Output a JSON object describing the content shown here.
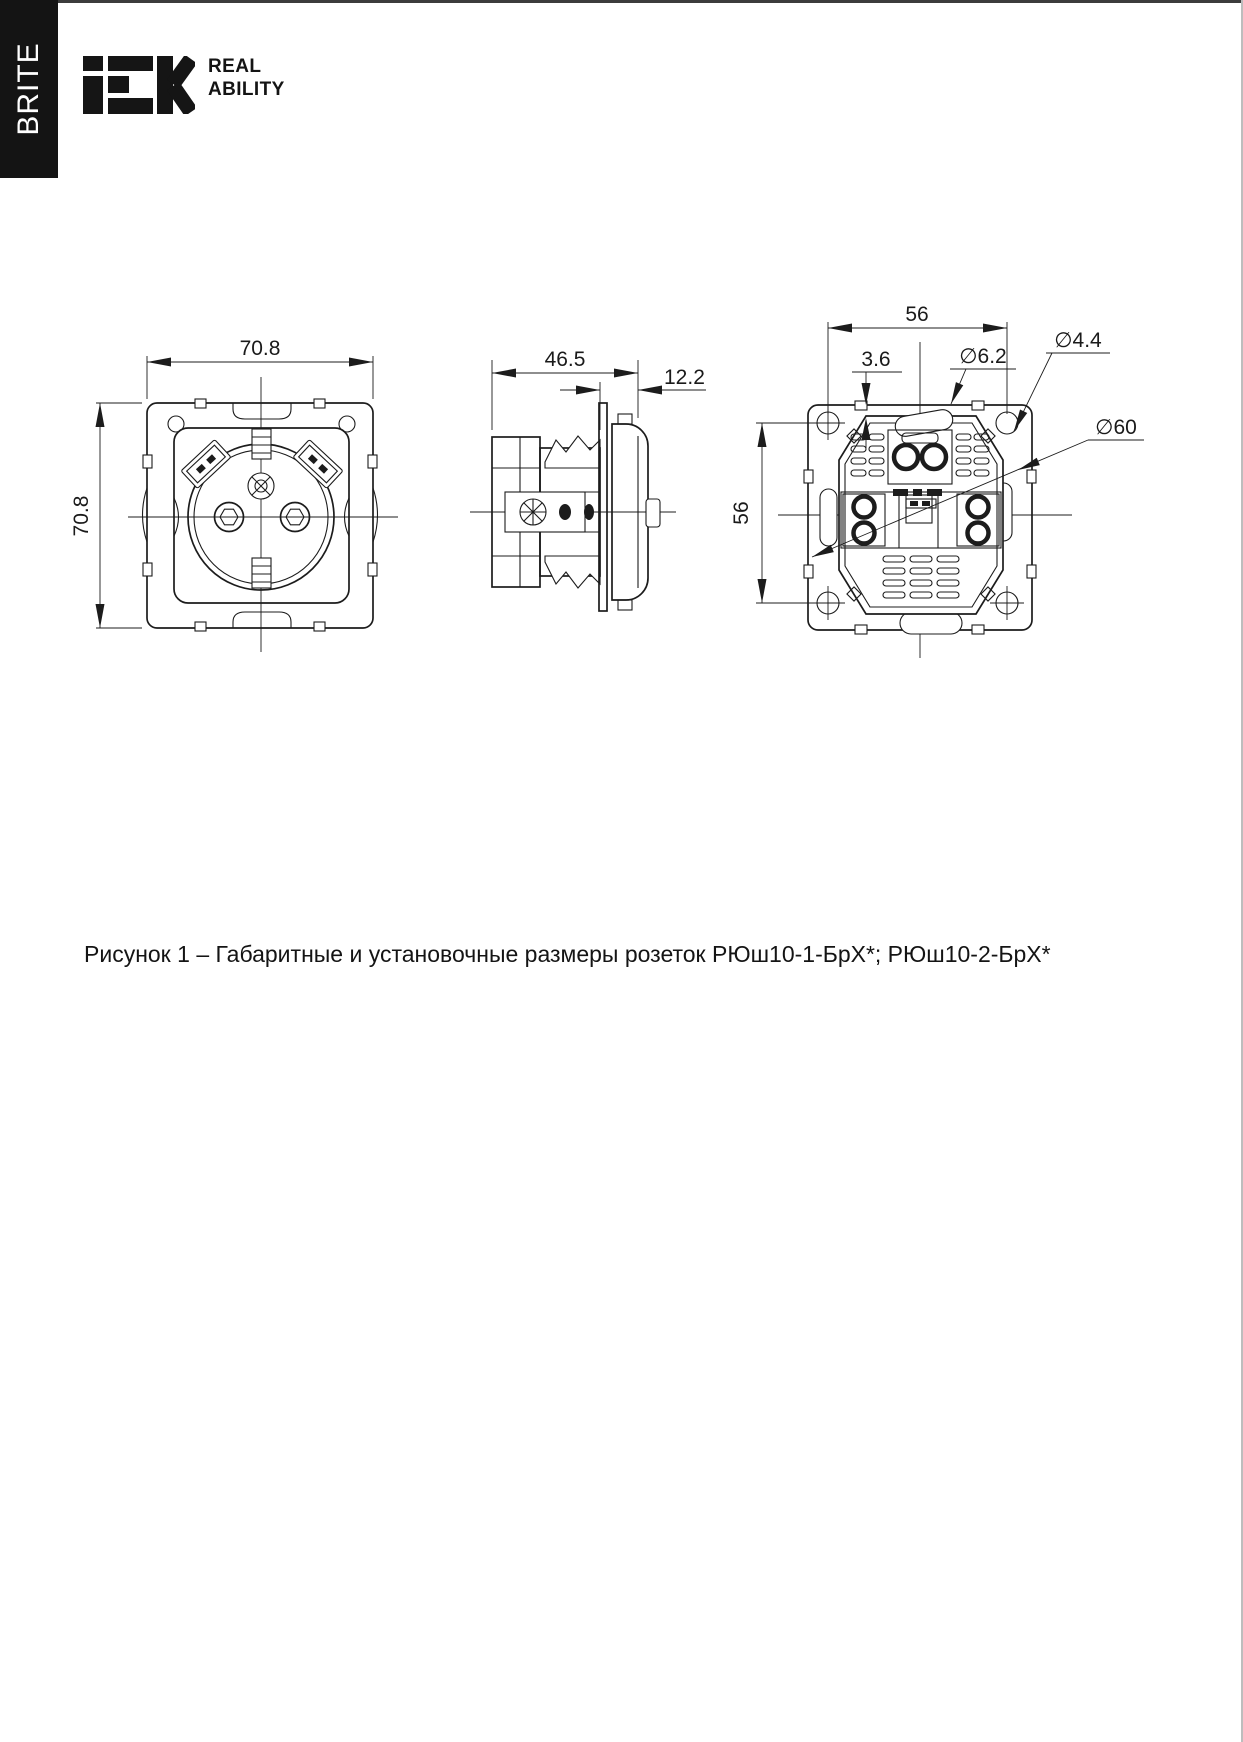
{
  "page": {
    "side_tab": "BRITE",
    "tagline": {
      "line1": "REAL",
      "line2": "ABILITY"
    }
  },
  "figure": {
    "caption": "Рисунок 1 – Габаритные и установочные размеры розеток РЮш10-1-БрХ*; РЮш10-2-БрХ*",
    "front_view": {
      "width_mm": "70.8",
      "height_mm": "70.8"
    },
    "side_view": {
      "depth_mm": "46.5",
      "frame_depth_mm": "12.2"
    },
    "rear_view": {
      "hole_spacing_h_mm": "56",
      "hole_spacing_v_mm": "56",
      "offset_mm": "3.6",
      "slot_dia": "∅6.2",
      "hole_dia": "∅4.4",
      "body_dia": "∅60"
    }
  }
}
